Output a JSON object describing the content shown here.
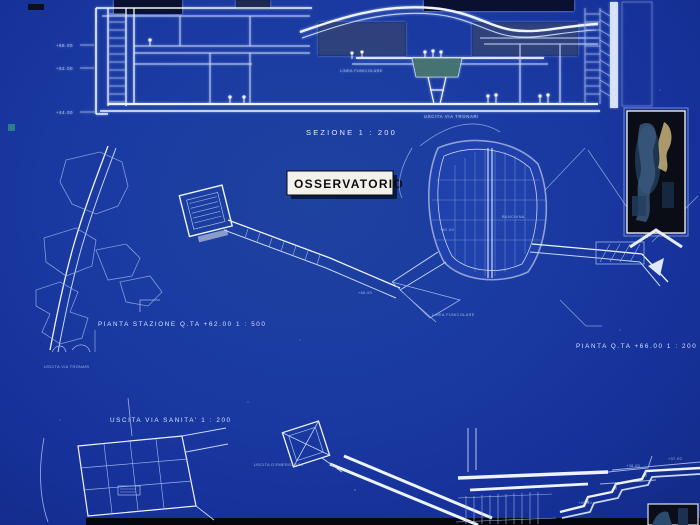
{
  "drawing": {
    "title": "OSSERVATORIO",
    "section_label": "SEZIONE   1 : 200",
    "plan_station_label": "PIANTA   STAZIONE   Q.TA   +62.00   1 : 500",
    "plan_66_label": "PIANTA   Q.TA   +66.00   1 : 200",
    "exit_sanita_label": "USCITA   VIA   SANITA'   1 : 200",
    "emergency_exit_label": "USCITA D'EMERGENZA",
    "exit_tronari_section_label": "USCITA   VIA   TRONARI",
    "exit_tronari_plan_label": "USCITA   VIA   TRONARI",
    "linea_funicolare_section": "LINEA FUNICOLARE",
    "linea_funicolare_plan": "LINEA FUNICOLARE",
    "banchina_label": "BANCHINA",
    "quota_62": "+62.00",
    "quota_66": "+66.00",
    "elevations_section": {
      "top": "+66.00",
      "mid": "+62.00",
      "bottom": "+44.00"
    },
    "elevations_br": {
      "a": "+38.00",
      "b": "+37.00",
      "c": "+40.00"
    }
  },
  "colors": {
    "background": "#1a3aa2",
    "line_bright": "#eef4ff",
    "line_mid": "#c7d5f6",
    "line_faint": "#9db3e8",
    "label_text": "#d8e3ff",
    "title_box_bg": "#f2f2ea",
    "title_box_text": "#0c0c12",
    "dark_fill": "#0a1130",
    "teal_car": "#3f6e68",
    "photo_dark": "#0a0d16",
    "teal_dot": "#2d7d8c"
  }
}
